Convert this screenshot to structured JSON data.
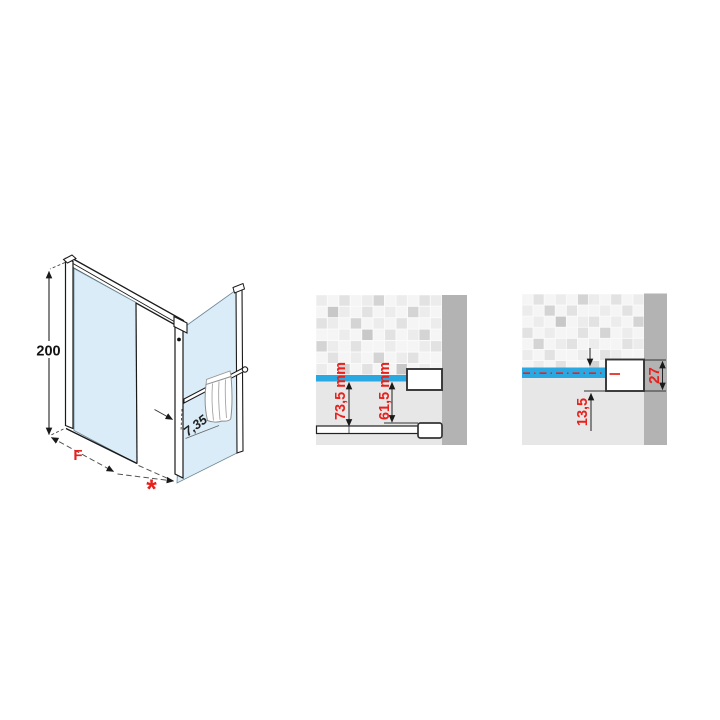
{
  "iso_diagram": {
    "height_label": "200",
    "width_label": "F",
    "entry_label": "*",
    "offset_label": "7,35"
  },
  "detail_top_bar": {
    "dim_outer": "73,5 mm",
    "dim_inner": "61,5 mm"
  },
  "detail_wall_bracket": {
    "dim_depth": "13,5",
    "dim_height": "27"
  },
  "colors": {
    "accent_red": "#e8211c",
    "bar_blue": "#29a8e2",
    "glass_blue": "#d9ecf8",
    "wall_gray": "#b3b3b3",
    "panel_gray": "#e7e7e7",
    "grout_white": "#fafafa",
    "line_dark": "#1a1a1a",
    "tile_shades": [
      "#f5f5f5",
      "#ececec",
      "#e2e2e2",
      "#d4d4d4",
      "#c8c8c8"
    ]
  },
  "decor": {
    "tiles_mid": [
      [
        1,
        0,
        2,
        0,
        1,
        3,
        0,
        1,
        0,
        2,
        1
      ],
      [
        0,
        4,
        1,
        0,
        2,
        0,
        1,
        0,
        3,
        1,
        0
      ],
      [
        2,
        1,
        0,
        3,
        0,
        1,
        0,
        2,
        0,
        0,
        1
      ],
      [
        0,
        0,
        1,
        0,
        4,
        0,
        2,
        0,
        1,
        3,
        0
      ],
      [
        3,
        1,
        0,
        2,
        0,
        0,
        1,
        0,
        0,
        1,
        2
      ],
      [
        0,
        2,
        0,
        1,
        0,
        3,
        0,
        1,
        2,
        0,
        0
      ],
      [
        1,
        0,
        3,
        0,
        2,
        0,
        0,
        4,
        0,
        1,
        0
      ]
    ],
    "tiles_right": [
      [
        0,
        2,
        0,
        1,
        0,
        3,
        1,
        0,
        2,
        0,
        1
      ],
      [
        1,
        0,
        3,
        0,
        2,
        0,
        0,
        1,
        0,
        2,
        0
      ],
      [
        0,
        1,
        0,
        4,
        0,
        1,
        2,
        0,
        1,
        0,
        3
      ],
      [
        2,
        0,
        1,
        0,
        0,
        2,
        0,
        3,
        0,
        1,
        0
      ],
      [
        0,
        3,
        0,
        1,
        2,
        0,
        1,
        0,
        0,
        2,
        1
      ],
      [
        1,
        0,
        2,
        0,
        0,
        1,
        0,
        2,
        1,
        0,
        0
      ],
      [
        0,
        1,
        0,
        2,
        0,
        0,
        3,
        0,
        1,
        0,
        2
      ]
    ]
  }
}
